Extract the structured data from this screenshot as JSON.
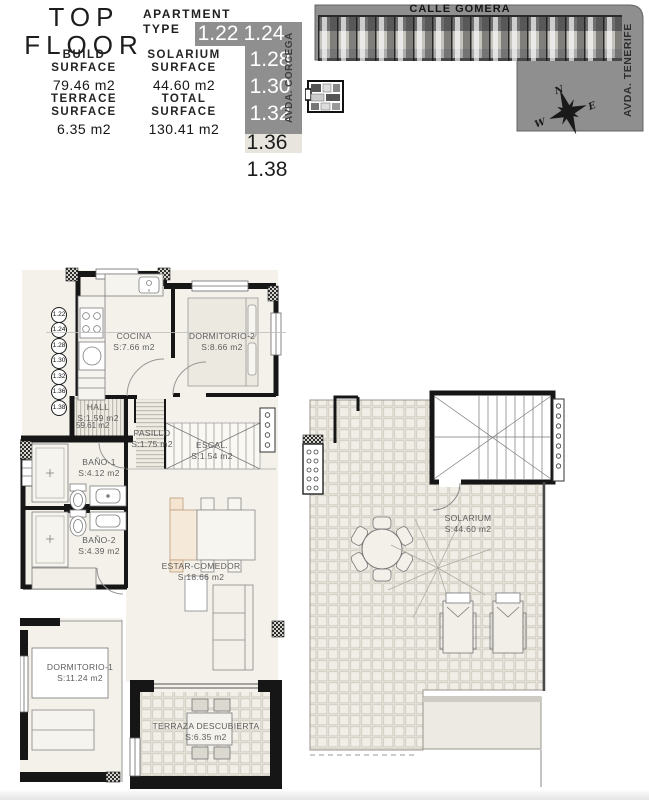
{
  "header": {
    "title": {
      "line1": "TOP",
      "line2": "FLOOR"
    },
    "apartment_type": {
      "line1": "APARTMENT",
      "line2": "TYPE"
    },
    "stats": [
      {
        "label1": "BUILD",
        "label2": "SURFACE",
        "value": "79.46 m2"
      },
      {
        "label1": "SOLARIUM",
        "label2": "SURFACE",
        "value": "44.60 m2"
      },
      {
        "label1": "TERRACE",
        "label2": "SURFACE",
        "value": "6.35 m2"
      },
      {
        "label1": "TOTAL",
        "label2": "SURFACE",
        "value": "130.41 m2"
      }
    ]
  },
  "apartment_types": {
    "list": [
      "1.22",
      "1.24",
      "1.28",
      "1.30",
      "1.32",
      "1.36",
      "1.38"
    ],
    "highlighted": [
      "1.22",
      "1.24",
      "1.28",
      "1.30",
      "1.32"
    ]
  },
  "site_plan": {
    "street_top": "CALLE GOMERA",
    "street_right": "AVDA. TENERIFE",
    "street_left": "AVDA. CORCEGA",
    "compass": {
      "n": "N",
      "e": "E",
      "w": "W"
    }
  },
  "plan": {
    "rooms": {
      "cocina": {
        "name": "COCINA",
        "area": "S:7.66 m2"
      },
      "dormitorio2": {
        "name": "DORMITORIO-2",
        "area": "S:8.66 m2"
      },
      "hall": {
        "name": "HALL",
        "area": "S:1.59 m2",
        "note": "59.61 m2"
      },
      "pasillo": {
        "name": "PASILLO",
        "area": "S:1.75 m2"
      },
      "escalera": {
        "name": "ESCAL.",
        "area": "S:1.54 m2"
      },
      "bano1": {
        "name": "BAÑO-1",
        "area": "S:4.12 m2"
      },
      "bano2": {
        "name": "BAÑO-2",
        "area": "S:4.39 m2"
      },
      "estar": {
        "name": "ESTAR-COMEDOR",
        "area": "S:18.66 m2"
      },
      "dormitorio1": {
        "name": "DORMITORIO-1",
        "area": "S:11.24 m2"
      },
      "terraza": {
        "name": "TERRAZA DESCUBIERTA",
        "area": "S:6.35 m2"
      },
      "solarium": {
        "name": "SOLARIUM",
        "area": "S:44.60 m2"
      }
    }
  },
  "colors": {
    "site_gray": "#8f8f8f",
    "wall": "#161616",
    "tile_joint": "#c8c4b9"
  }
}
